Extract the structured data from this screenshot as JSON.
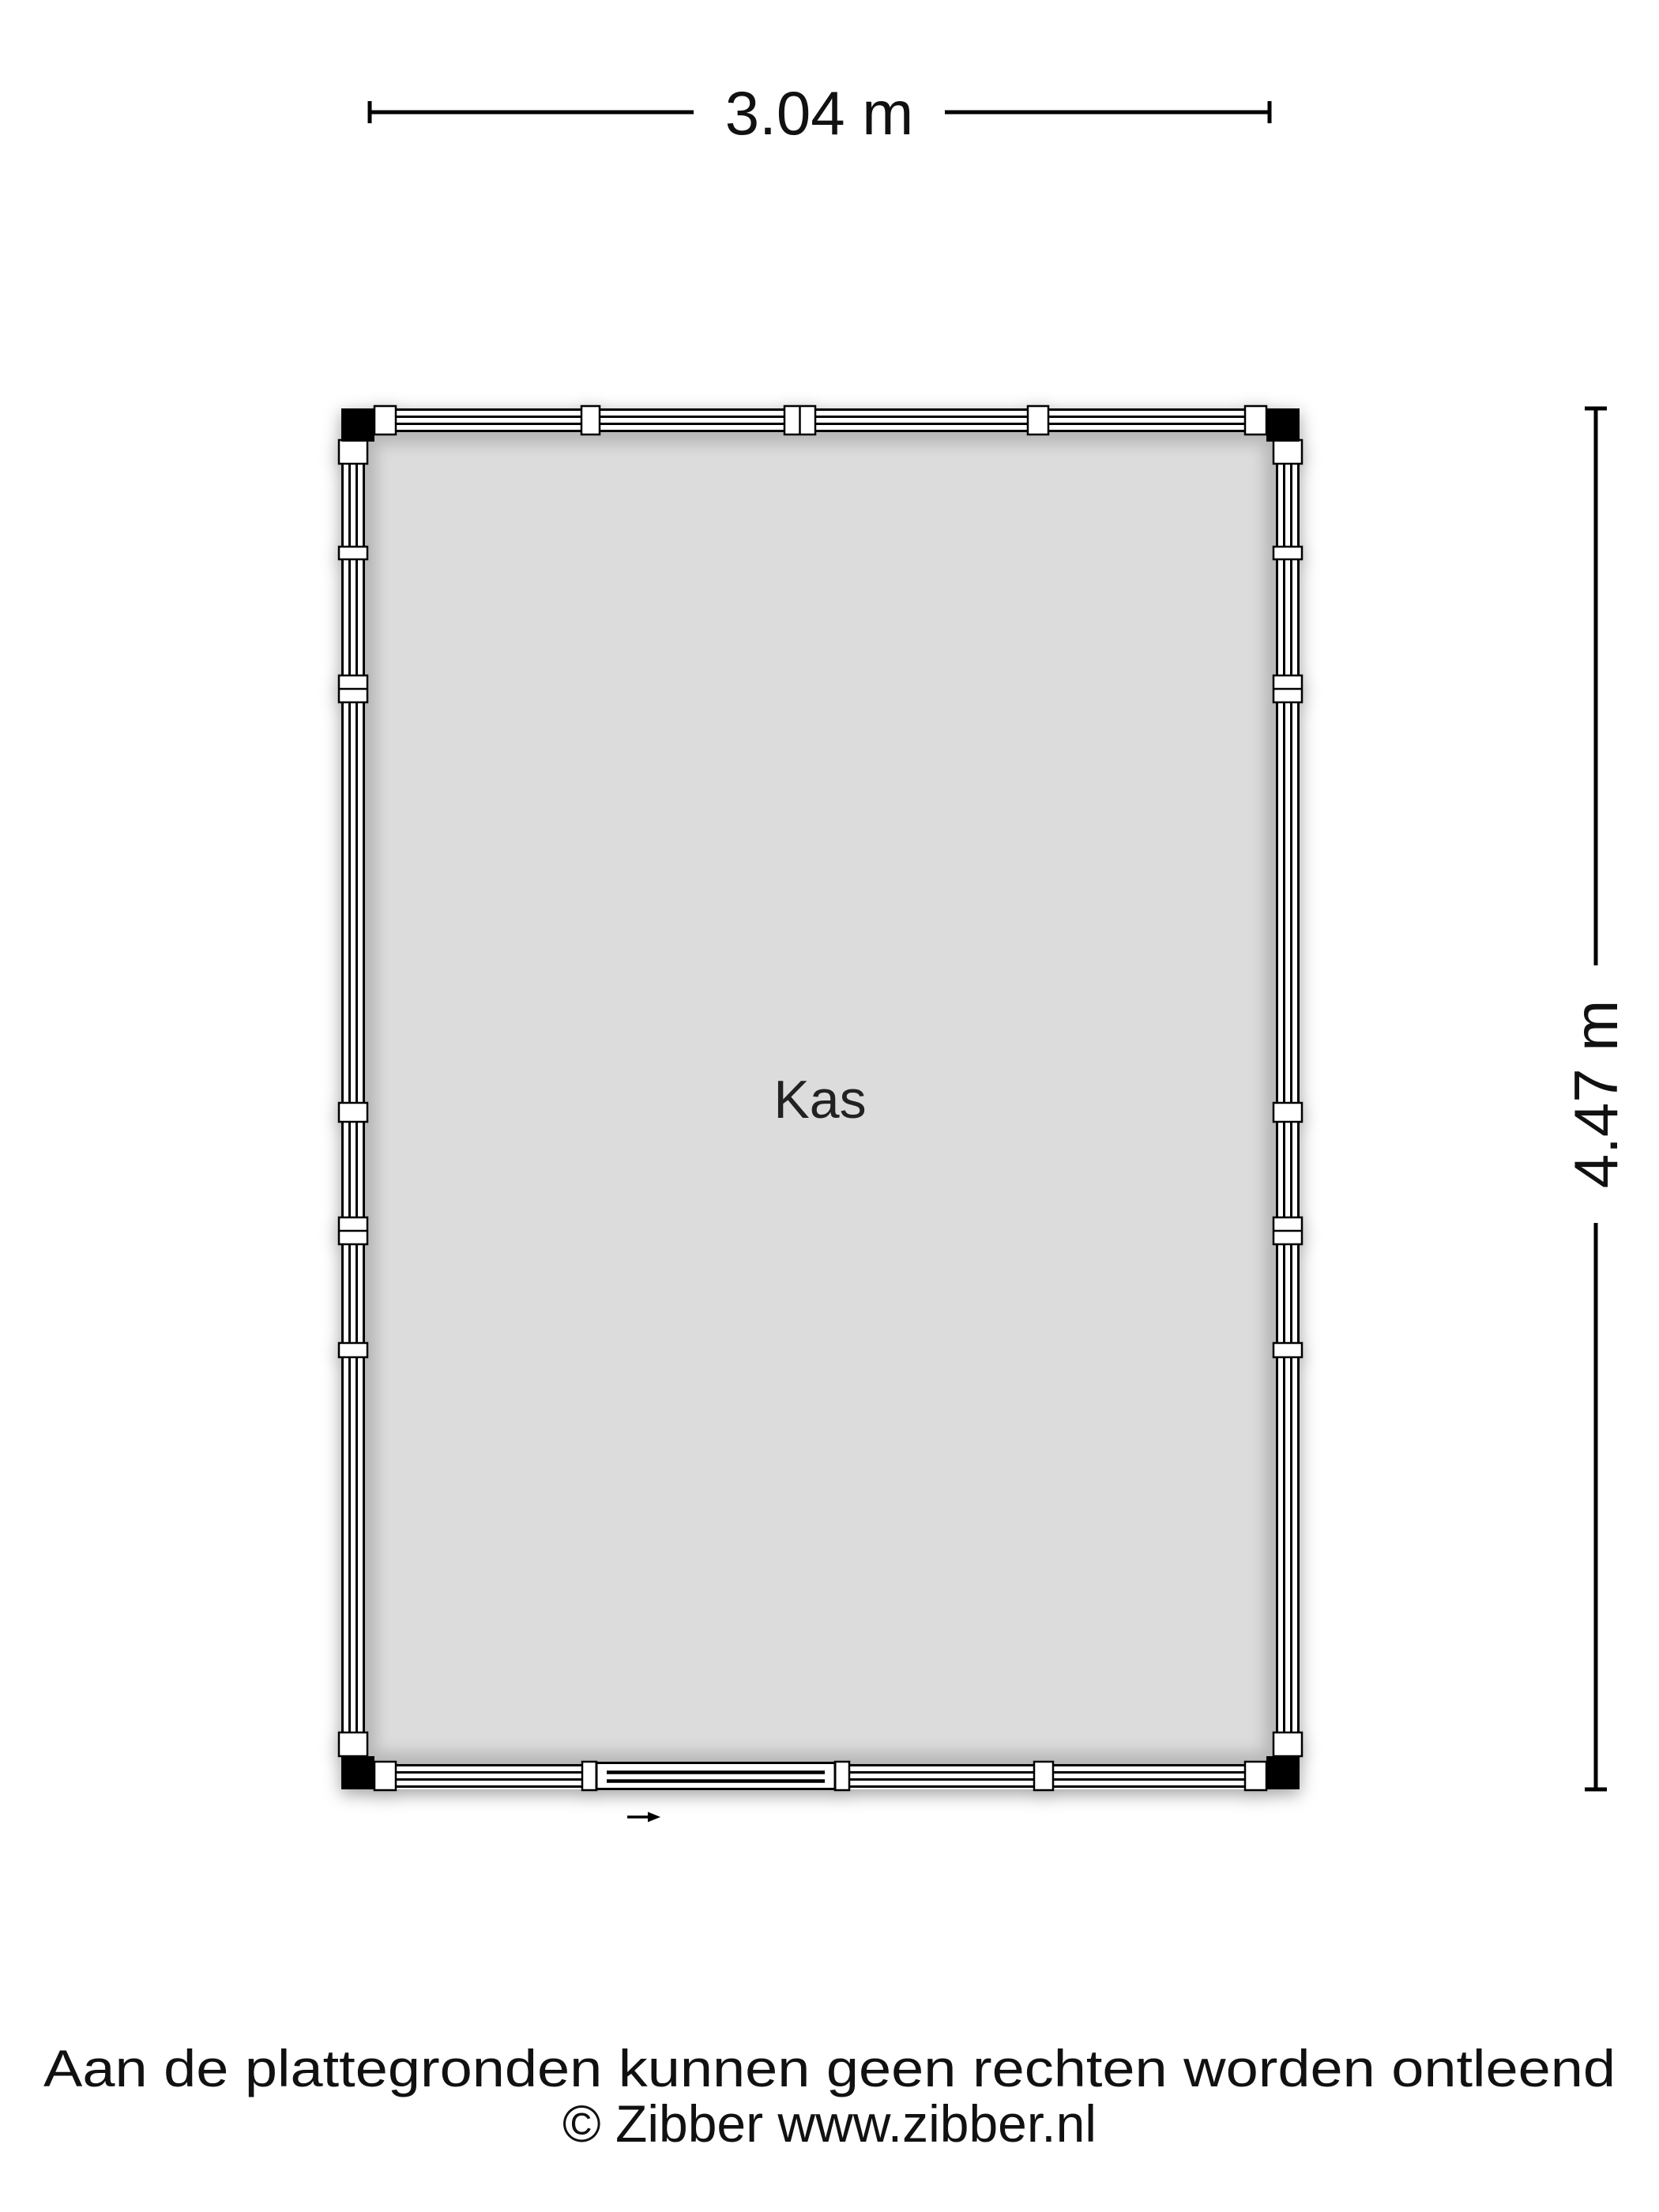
{
  "floorplan": {
    "room": {
      "label": "Kas"
    },
    "dimensions": {
      "width_label": "3.04 m",
      "height_label": "4.47 m"
    },
    "colors": {
      "interior": "#dcdcdc",
      "wall_fill": "#ffffff",
      "line": "#000000",
      "background": "#ffffff"
    }
  },
  "footer": {
    "disclaimer": "Aan de plattegronden kunnen geen rechten worden ontleend",
    "copyright": "© Zibber www.zibber.nl"
  }
}
